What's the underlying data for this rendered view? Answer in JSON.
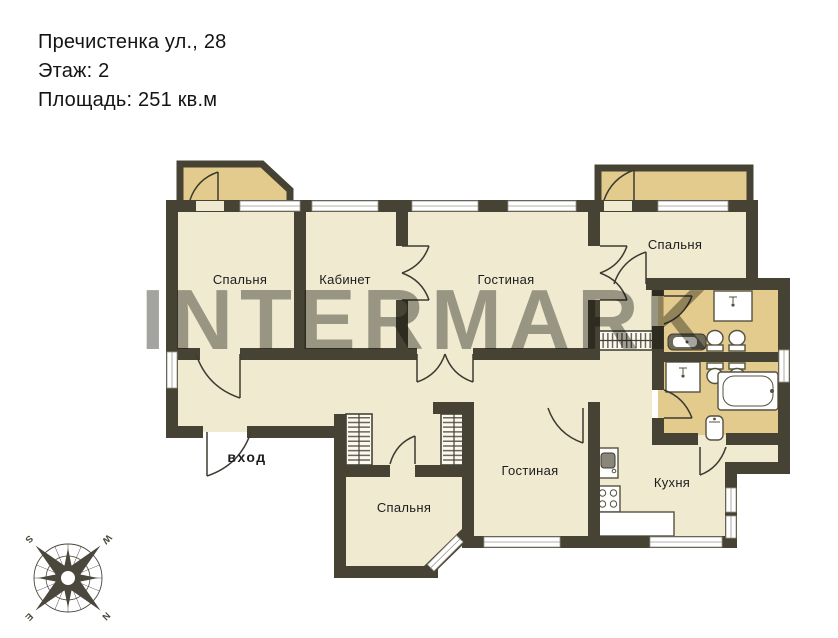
{
  "header": {
    "address": "Пречистенка ул., 28",
    "floor": "Этаж: 2",
    "area": "Площадь: 251 кв.м"
  },
  "watermark": "INTERMARK",
  "plan": {
    "rooms": [
      {
        "label": "Спальня"
      },
      {
        "label": "Кабинет"
      },
      {
        "label": "Гостиная"
      },
      {
        "label": "Спальня"
      },
      {
        "label": "Спальня"
      },
      {
        "label": "Гостиная"
      },
      {
        "label": "Кухня"
      }
    ],
    "entrance_label": "вход"
  },
  "compass": {
    "n": "N",
    "e": "E",
    "s": "S",
    "w": "W"
  },
  "colors": {
    "wall": "#474334",
    "floor": "#f0ead1",
    "accent_floor": "#e2cb8d",
    "watermark_gray": "#99999 6",
    "text": "#141414"
  }
}
